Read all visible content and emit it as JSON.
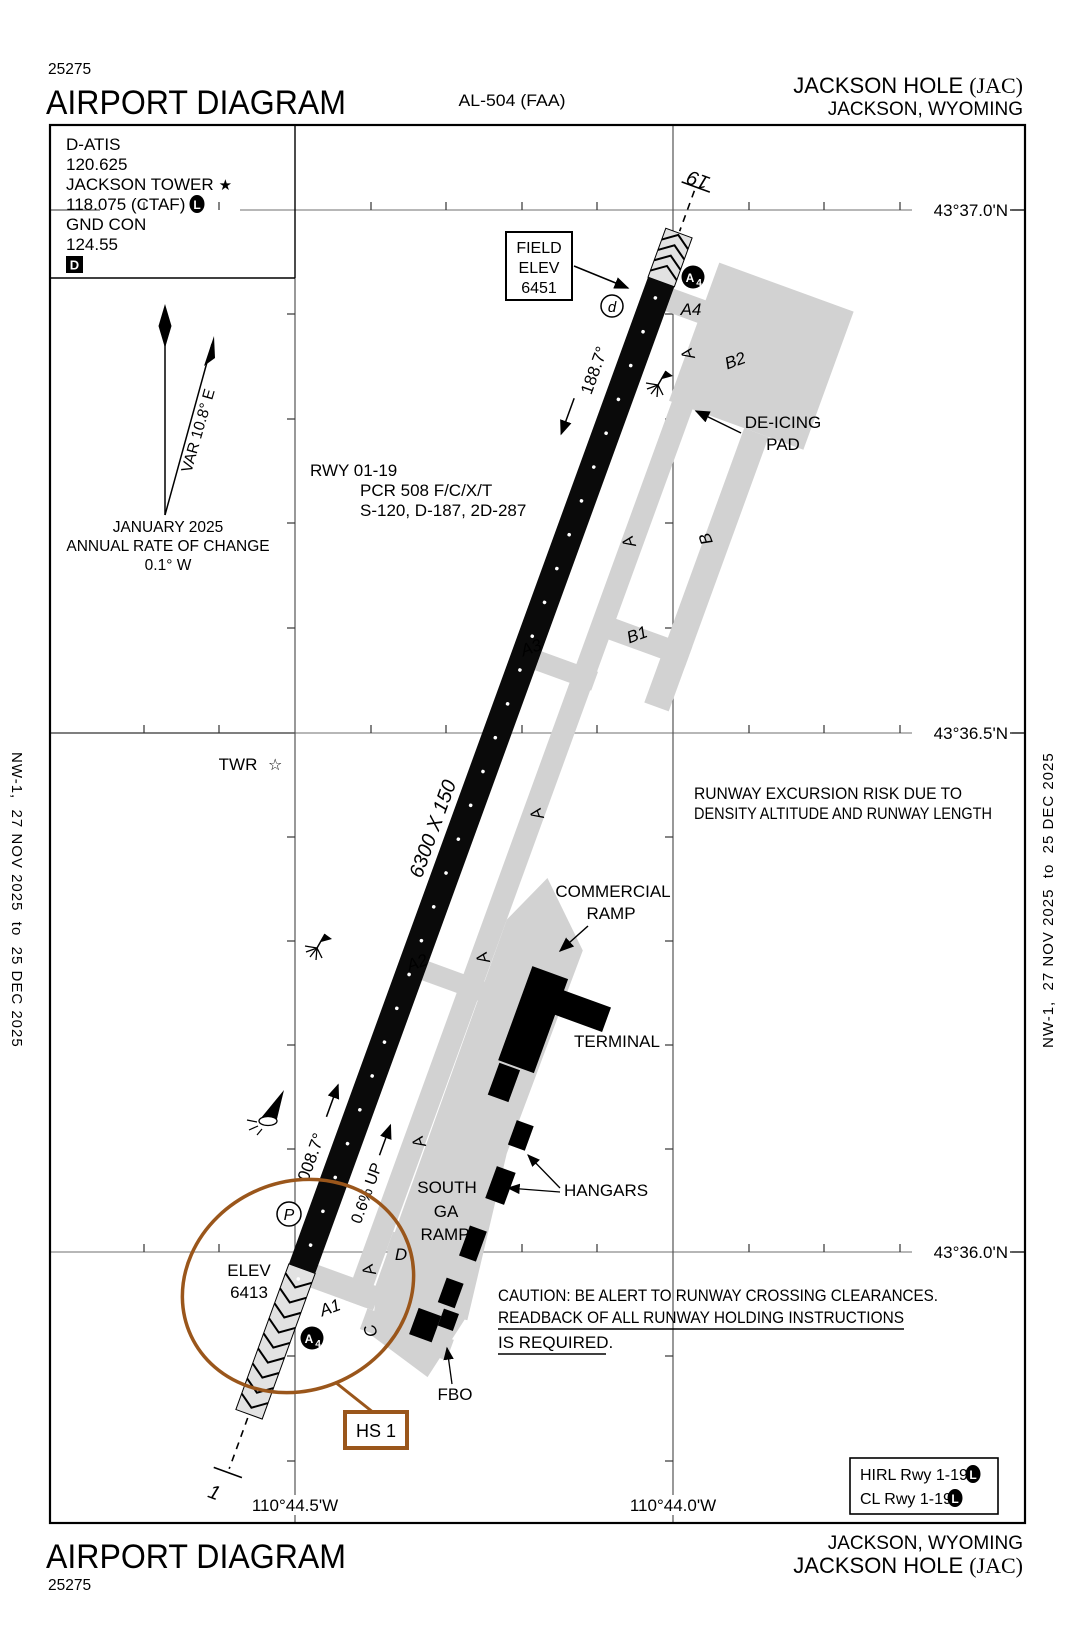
{
  "header": {
    "chart_number": "25275",
    "title": "AIRPORT DIAGRAM",
    "procedure_id": "AL-504 (FAA)",
    "airport_name": "JACKSON HOLE",
    "airport_id": "(JAC)",
    "city": "JACKSON, WYOMING"
  },
  "footer": {
    "chart_number": "25275",
    "title": "AIRPORT DIAGRAM",
    "airport_name": "JACKSON HOLE",
    "airport_id": "(JAC)",
    "city": "JACKSON, WYOMING"
  },
  "side_label": "NW-1,  27 NOV 2025  to  25 DEC 2025",
  "comm": {
    "datis_label": "D-ATIS",
    "datis_freq": "120.625",
    "tower_label": "JACKSON TOWER",
    "tower_freq": "118.075 (CTAF)",
    "gnd_label": "GND CON",
    "gnd_freq": "124.55"
  },
  "compass": {
    "var": "VAR 10.8° E",
    "month": "JANUARY 2025",
    "rate_line1": "ANNUAL RATE OF CHANGE",
    "rate_line2": "0.1° W"
  },
  "field_elev": {
    "l1": "FIELD",
    "l2": "ELEV",
    "l3": "6451"
  },
  "rwy_data": {
    "l1": "RWY 01-19",
    "l2": "PCR 508 F/C/X/T",
    "l3": "S-120, D-187, 2D-287"
  },
  "runway": {
    "num_19": "19",
    "num_1": "1",
    "dim": "6300 X 150",
    "hdg19": "188.7°",
    "hdg01": "008.7°",
    "slope": "0.6% UP",
    "elev_label": "ELEV",
    "elev_value": "6413"
  },
  "grid": {
    "lat": [
      "43°37.0'N",
      "43°36.5'N",
      "43°36.0'N"
    ],
    "lon": [
      "110°44.5'W",
      "110°44.0'W"
    ]
  },
  "tx": {
    "a": "A",
    "a1": "A1",
    "a2": "A2",
    "a3": "A3",
    "a4": "A4",
    "b": "B",
    "b1": "B1",
    "b2": "B2",
    "c": "C",
    "d": "D"
  },
  "apron": {
    "deicing_l1": "DE-ICING",
    "deicing_l2": "PAD",
    "comm_l1": "COMMERCIAL",
    "comm_l2": "RAMP",
    "terminal": "TERMINAL",
    "hangars": "HANGARS",
    "south_l1": "SOUTH",
    "south_l2": "GA",
    "south_l3": "RAMP",
    "fbo": "FBO",
    "twr": "TWR"
  },
  "notes": {
    "excursion_l1": "RUNWAY EXCURSION RISK DUE TO",
    "excursion_l2": "DENSITY ALTITUDE AND RUNWAY LENGTH",
    "caution_l1": "CAUTION: BE ALERT TO RUNWAY CROSSING CLEARANCES.",
    "caution_l2": "READBACK OF ALL RUNWAY HOLDING INSTRUCTIONS",
    "caution_l3": "IS REQUIRED."
  },
  "hotspot": {
    "box": "HS 1",
    "circle_a": "A",
    "circle_4": "4"
  },
  "lighting": {
    "l1": "HIRL Rwy 1-19",
    "l2": "CL Rwy 1-19"
  },
  "symbols": {
    "p": "P",
    "d": "d",
    "l": "L",
    "d_sq": "D",
    "star_filled": "★",
    "star_open": "☆"
  },
  "colors": {
    "hotspot_brown": "#9A561B",
    "taxiway_gray": "#D2D2D2"
  }
}
